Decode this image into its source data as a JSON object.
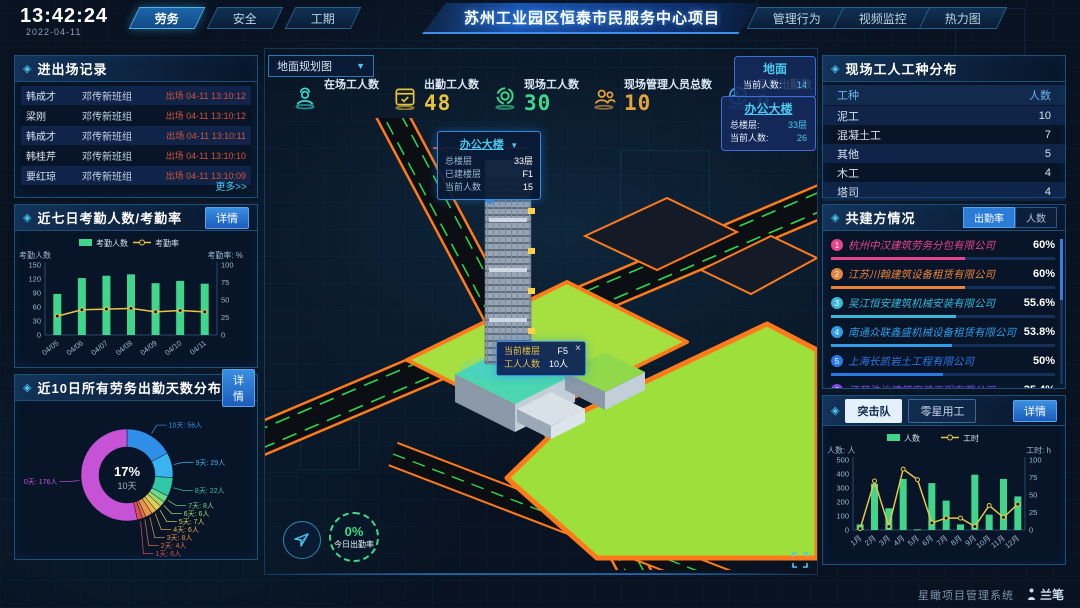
{
  "header": {
    "time": "13:42:24",
    "date": "2022-04-11",
    "left_tabs": [
      {
        "label": "劳务",
        "active": true
      },
      {
        "label": "安全",
        "active": false
      },
      {
        "label": "工期",
        "active": false
      }
    ],
    "title": "苏州工业园区恒泰市民服务中心项目",
    "right_tabs": [
      {
        "label": "管理行为"
      },
      {
        "label": "视频监控"
      },
      {
        "label": "热力图"
      }
    ]
  },
  "entry_exit": {
    "title": "进出场记录",
    "more_label": "更多>>",
    "rows": [
      {
        "name": "韩成才",
        "group": "邓传新班组",
        "event": "出场 04-11 13:10:12"
      },
      {
        "name": "梁刚",
        "group": "邓传新班组",
        "event": "出场 04-11 13:10:12"
      },
      {
        "name": "韩成才",
        "group": "邓传新班组",
        "event": "出场 04-11 13:10:11"
      },
      {
        "name": "韩桂芹",
        "group": "邓传新班组",
        "event": "出场 04-11 13:10:10"
      },
      {
        "name": "要红琼",
        "group": "邓传新班组",
        "event": "出场 04-11 13:10:09"
      }
    ]
  },
  "attendance_panel": {
    "title": "近七日考勤人数/考勤率",
    "detail_label": "详情"
  },
  "distribution_panel": {
    "title": "近10日所有劳务出勤天数分布",
    "detail_label": "详情"
  },
  "scene": {
    "layer_select": "地面规划图",
    "stats": [
      {
        "label": "在场工人数",
        "value": "",
        "color": "#3bd6d0"
      },
      {
        "label": "出勤工人数",
        "value": "48",
        "color": "#e8c23a"
      },
      {
        "label": "现场工人数",
        "value": "30",
        "color": "#3fd68c"
      },
      {
        "label": "现场管理人员总数",
        "value": "10",
        "color": "#e8a23a"
      },
      {
        "label": "异常出勤数",
        "value": "0",
        "color": "#35a8e8"
      }
    ],
    "building_tooltip": {
      "title": "办公大楼",
      "rows": [
        [
          "总楼层",
          "33层"
        ],
        [
          "已建楼层",
          "F1"
        ],
        [
          "当前人数",
          "15"
        ]
      ]
    },
    "floor_tooltip": {
      "close": "×",
      "rows": [
        [
          "当前楼层",
          "F5"
        ],
        [
          "工人人数",
          "10人"
        ]
      ]
    },
    "ground_card": {
      "title": "地面",
      "rows": [
        [
          "当前人数:",
          "14"
        ]
      ]
    },
    "tower_card": {
      "title": "办公大楼",
      "rows": [
        [
          "总楼层:",
          "33层"
        ],
        [
          "当前人数:",
          "26"
        ]
      ]
    },
    "gauge": {
      "value": "0%",
      "label": "今日出勤率"
    }
  },
  "worker_types": {
    "title": "现场工人工种分布",
    "columns": [
      "工种",
      "人数"
    ],
    "rows": [
      [
        "泥工",
        "10"
      ],
      [
        "混凝土工",
        "7"
      ],
      [
        "其他",
        "5"
      ],
      [
        "木工",
        "4"
      ],
      [
        "塔司",
        "4"
      ]
    ]
  },
  "partners": {
    "title": "共建方情况",
    "tabs": [
      {
        "label": "出勤率",
        "active": true
      },
      {
        "label": "人数",
        "active": false
      }
    ],
    "rows": [
      {
        "rank": "1",
        "name": "杭州中汉建筑劳务分包有限公司",
        "pct": "60%",
        "value": 60,
        "color": "#e8448c"
      },
      {
        "rank": "2",
        "name": "江苏川翰建筑设备租赁有限公司",
        "pct": "60%",
        "value": 60,
        "color": "#e8833a"
      },
      {
        "rank": "3",
        "name": "吴江恒安建筑机械安装有限公司",
        "pct": "55.6%",
        "value": 55.6,
        "color": "#3ab8d9"
      },
      {
        "rank": "4",
        "name": "南通众联鑫盛机械设备租赁有限公司",
        "pct": "53.8%",
        "value": 53.8,
        "color": "#2e9de8"
      },
      {
        "rank": "5",
        "name": "上海长凯岩土工程有限公司",
        "pct": "50%",
        "value": 50,
        "color": "#2979e8"
      },
      {
        "rank": "6",
        "name": "江苏浩诒建筑安装工程有限公司",
        "pct": "35.4%",
        "value": 35.4,
        "color": "#7a4ae8"
      }
    ]
  },
  "squad_panel": {
    "tabs": [
      {
        "label": "突击队",
        "active": true
      },
      {
        "label": "零星用工",
        "active": false
      }
    ],
    "detail_label": "详情"
  },
  "footer": {
    "brand": "星瞰项目管理系统",
    "logo": "兰笔"
  },
  "chart_data": [
    {
      "id": "attendance",
      "type": "bar+line",
      "title": "近七日考勤人数/考勤率",
      "categories": [
        "04/05",
        "04/06",
        "04/07",
        "04/08",
        "04/09",
        "04/10",
        "04/11"
      ],
      "series": [
        {
          "name": "考勤人数",
          "type": "bar",
          "axis": "left",
          "color": "#3fd68c",
          "values": [
            88,
            122,
            127,
            130,
            111,
            116,
            110
          ]
        },
        {
          "name": "考勤率",
          "type": "line",
          "axis": "right",
          "color": "#e8c547",
          "values": [
            27,
            36,
            37,
            38,
            33,
            35,
            33
          ]
        }
      ],
      "axes": {
        "left": {
          "title": "考勤人数",
          "min": 0,
          "max": 150,
          "step": 30
        },
        "right": {
          "title": "考勤率: %",
          "min": 0,
          "max": 100,
          "step": 25
        }
      },
      "legend_position": "top"
    },
    {
      "id": "attendance_days_donut",
      "type": "pie",
      "title": "近10日所有劳务出勤天数分布",
      "center_label": {
        "pct": "17%",
        "name": "10天"
      },
      "segments": [
        {
          "label": "10天",
          "value": 56,
          "unit": "人",
          "color": "#2f8fe8"
        },
        {
          "label": "9天",
          "value": 29,
          "unit": "人",
          "color": "#3ab4f0"
        },
        {
          "label": "8天",
          "value": 22,
          "unit": "人",
          "color": "#30c9a8"
        },
        {
          "label": "7天",
          "value": 8,
          "unit": "人",
          "color": "#6fd98a"
        },
        {
          "label": "6天",
          "value": 6,
          "unit": "人",
          "color": "#a8d96a"
        },
        {
          "label": "5天",
          "value": 7,
          "unit": "人",
          "color": "#d9d05a"
        },
        {
          "label": "4天",
          "value": 6,
          "unit": "人",
          "color": "#e8b34a"
        },
        {
          "label": "3天",
          "value": 8,
          "unit": "人",
          "color": "#e8934a"
        },
        {
          "label": "2天",
          "value": 4,
          "unit": "人",
          "color": "#e2704d"
        },
        {
          "label": "1天",
          "value": 6,
          "unit": "人",
          "color": "#d94f4f"
        },
        {
          "label": "0天",
          "value": 176,
          "unit": "人",
          "color": "#c653d6"
        }
      ]
    },
    {
      "id": "squad_monthly",
      "type": "bar+line",
      "title": "突击队",
      "categories": [
        "1月",
        "2月",
        "3月",
        "4月",
        "5月",
        "6月",
        "7月",
        "8月",
        "9月",
        "10月",
        "11月",
        "12月"
      ],
      "series": [
        {
          "name": "人数",
          "type": "bar",
          "axis": "left",
          "color": "#3fd68c",
          "values": [
            40,
            330,
            155,
            365,
            5,
            335,
            210,
            40,
            395,
            110,
            365,
            240
          ]
        },
        {
          "name": "工时",
          "type": "line",
          "axis": "right",
          "color": "#e8c547",
          "values": [
            2,
            70,
            5,
            87,
            72,
            10,
            17,
            17,
            5,
            35,
            18,
            37
          ]
        }
      ],
      "axes": {
        "left": {
          "title": "人数: 人",
          "min": 0,
          "max": 500,
          "step": 100
        },
        "right": {
          "title": "工时: h",
          "min": 0,
          "max": 100,
          "step": 25
        }
      },
      "legend_position": "top"
    }
  ]
}
